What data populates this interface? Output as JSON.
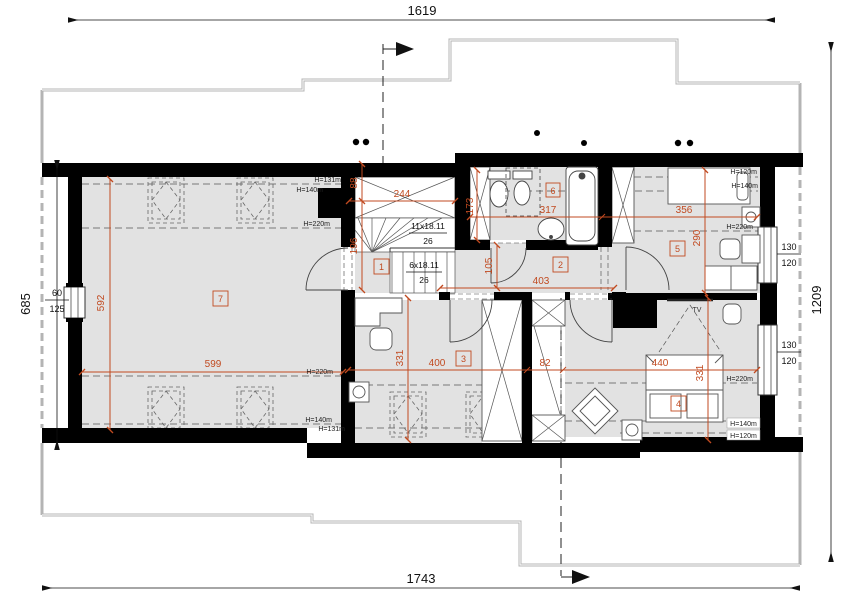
{
  "plan": {
    "outer": {
      "top": "1619",
      "bottom": "1743",
      "left": "685",
      "right": "1209"
    },
    "tags": {
      "r1": "1",
      "r2": "2",
      "r3": "3",
      "r4": "4",
      "r5": "5",
      "r6": "6",
      "r7": "7"
    },
    "dims": {
      "stair_open_h": "88",
      "stair_open_w": "244",
      "stair_len": "196",
      "r7_len": "592",
      "r7_w": "599",
      "bath_w": "173",
      "bath_len": "317",
      "hall_w": "105",
      "hall_len": "403",
      "r3_w": "400",
      "r3_len": "331",
      "closet": "82",
      "r4_w": "440",
      "r4_len": "331",
      "r5_len": "356",
      "r5_w": "290"
    },
    "stairs": {
      "upper_flight": "11x18.11",
      "upper_width": "26",
      "lower_flight": "6x18.11",
      "lower_width": "26"
    },
    "windows": {
      "left": {
        "w": "60",
        "h": "125"
      },
      "right_top": {
        "w": "130",
        "h": "120"
      },
      "right_bottom": {
        "w": "130",
        "h": "120"
      }
    },
    "heights": {
      "h120": "H=120m",
      "h131": "H=131m",
      "h140": "H=140m",
      "h220": "H=220m"
    },
    "furniture": {
      "tv": "TV"
    },
    "colors": {
      "accent": "#c14a20",
      "wall": "#000000",
      "floor": "#e2e2e2",
      "roof_edge": "#b4b4b4"
    }
  }
}
